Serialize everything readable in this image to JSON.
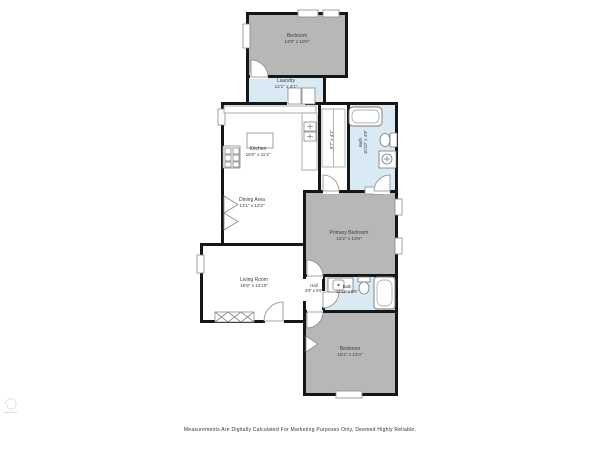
{
  "colors": {
    "wall": "#161616",
    "bedroom_fill": "#b7b7b7",
    "wet_room_fill": "#d9eaf5",
    "room_fill": "#ffffff",
    "label_text": "#3c3c3c"
  },
  "rooms": {
    "bedroom_top": {
      "name": "Bedroom",
      "dims": "13'8\" x 10'0\""
    },
    "laundry": {
      "name": "Laundry",
      "dims": "12'1\" x 4'1\""
    },
    "kitchen": {
      "name": "Kitchen",
      "dims": "15'0\" x 11'2\""
    },
    "closet": {
      "dims": "9'7\" x 4'1\""
    },
    "bath_upper": {
      "name": "Bath",
      "dims": "10'10\" x 4'9\""
    },
    "dining": {
      "name": "Dining Area",
      "dims": "13'1\" x 12'2\""
    },
    "primary_bedroom": {
      "name": "Primary Bedroom",
      "dims": "15'2\" x 13'9\""
    },
    "living_room": {
      "name": "Living Room",
      "dims": "16'9\" x 12'10\""
    },
    "hall": {
      "name": "Hall",
      "dims": "3'9\" x 5'6\""
    },
    "bath_lower": {
      "name": "Bath",
      "dims": "11'11\" x 5'6\""
    },
    "bedroom_bottom": {
      "name": "Bedroom",
      "dims": "15'2\" x 13'4\""
    }
  },
  "footer": {
    "disclaimer": "Measurements Are Digitally Calculated For Marketing Purposes Only, Deemed Highly Reliable."
  }
}
